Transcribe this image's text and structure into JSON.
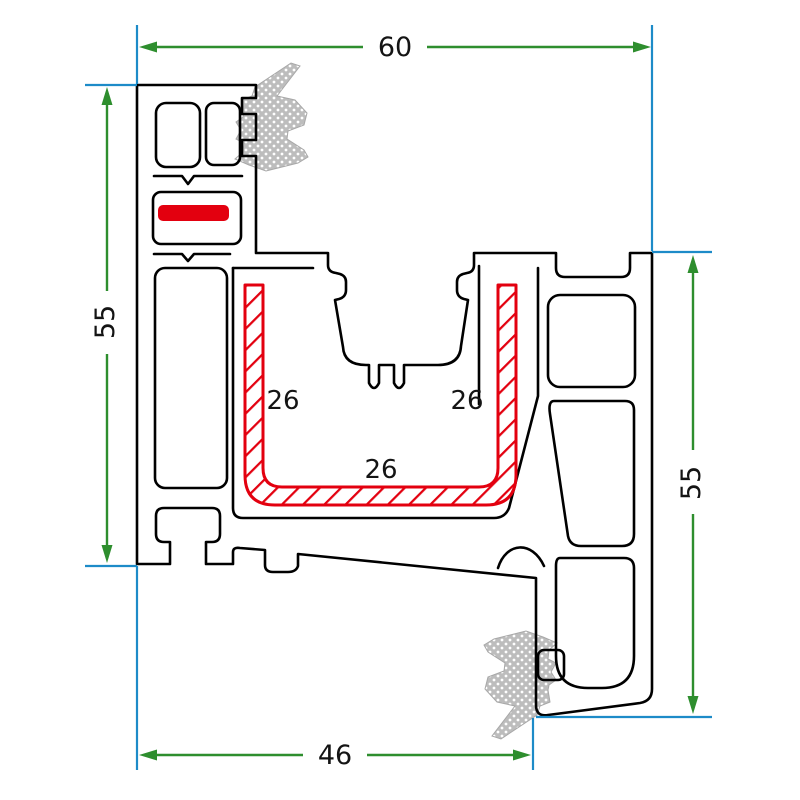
{
  "drawing": {
    "type": "profile-cross-section-technical-drawing",
    "dimensions": {
      "top_width": {
        "value": "60"
      },
      "left_height": {
        "value": "55"
      },
      "right_height": {
        "value": "55"
      },
      "bottom_width": {
        "value": "46"
      }
    },
    "reinforcement_labels": {
      "left": "26",
      "right": "26",
      "bottom": "26"
    },
    "colors": {
      "outline": "#000000",
      "dimension_line": "#2e8e2e",
      "extension_line": "#1d8bc8",
      "reinforcement_red": "#e3000f",
      "gasket_gray": "#bdbdbd",
      "label_text": "#141414",
      "background": "#ffffff"
    }
  }
}
